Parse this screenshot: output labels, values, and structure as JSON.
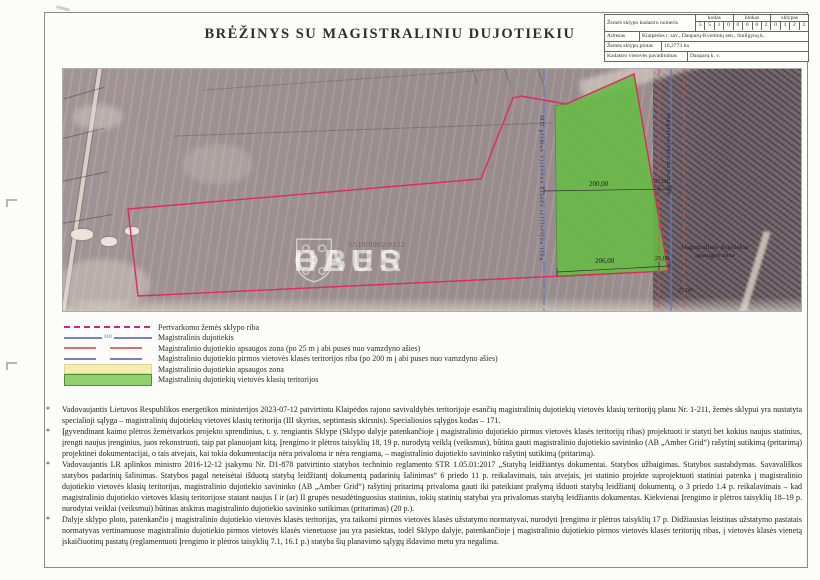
{
  "title": "BRĖŽINYS SU MAGISTRALINIU DUJOTIEKIU",
  "info_table": {
    "cadastre_label": "Žemės sklypo kadastro numeris",
    "col_headers": [
      "kodas",
      "blokas",
      "sklypas"
    ],
    "code_digits": [
      "5",
      "5",
      "1",
      "0"
    ],
    "block_digits": [
      "0",
      "0",
      "0",
      "2"
    ],
    "plot_digits": [
      "0",
      "1",
      "2",
      "2"
    ],
    "address_label": "Adresas",
    "address_value": "Klaipėdos r. sav., Dauparų-Kvietinių sen., Smilgynų k.",
    "area_label": "Žemės sklypo plotas",
    "area_value": "16,2773 ha",
    "cadastre_area_label": "Kadastro vietovės pavadinimas",
    "cadastre_area_value": "Dauparų k. v."
  },
  "map": {
    "parcel_number": "5510/0002:0122",
    "dim_200": "200,00",
    "dim_206": "206,00",
    "dim_25": "25,00",
    "md_boundary_label": "MD pirmos vietovės klasės teritorijos riba",
    "pipeline_label": "Magistralinis dujotiekis",
    "protection_label_line1": "Magistralinio dujotiekio",
    "protection_label_line2": "apsaugos zona",
    "watermark_left": "OBER",
    "watermark_right": "HAUS"
  },
  "legend": {
    "md_mark": "MD",
    "items": [
      {
        "type": "dash-magenta",
        "label": "Pertvarkomo žemės sklypo riba"
      },
      {
        "type": "line-blue-md",
        "label": "Magistralinis dujotiekis"
      },
      {
        "type": "dash-red",
        "label": "Magistralinio dujotiekio apsaugos zona (po 25 m į abi puses nuo vamzdyno ašies)"
      },
      {
        "type": "dash-blue",
        "label": "Magistralinio dujotiekio pirmos vietovės klasės teritorijos riba (po 200 m į abi puses nuo vamzdyno ašies)"
      },
      {
        "type": "fill-yellow",
        "label": "Magistralinio dujotiekio apsaugos zona"
      },
      {
        "type": "fill-green",
        "label": "Magistralinių dujotiekių vietovės klasių teritorijos"
      }
    ]
  },
  "notes_bullet": "*",
  "notes": [
    "Vadovaujantis Lietuvos Respublikos energetikos ministerijos 2023-07-12 patvirtintu Klaipėdos rajono savivaldybės teritorijoje esančių magistralinių dujotiekių vietovės klasių teritorijų planu Nr. 1-211, žemės sklypui yra nustatyta specialioji sąlyga – magistralinių dujotiekių vietovės klasių teritorija (III skyrius, septintasis skirsnis). Specialiosios sąlygos kodas – 171.",
    "Įgyvendinant kaimo plėtros žemėtvarkos projekto sprendinius, t. y. rengiantis Sklype (Sklypo dalyje patenkančioje į magistralinio dujotiekio pirmos vietovės klasės teritorijų ribas) projektuoti ir statyti bet kokius naujus statinius, įrengti naujus įrenginius, juos rekonstruoti, taip pat planuojant kitą, Įrengimo ir plėtros taisyklių 18, 19 p. nurodytą veiklą (veiksmus), būtina gauti magistralinio dujotiekio savininko (AB „Amber Grid“) rašytinį sutikimą (pritarimą) projektinei dokumentacijai, o tais atvejais, kai tokia dokumentacija nėra privaloma ir nėra rengiama, – magistralinio dujotiekio savininko rašytinį sutikimą (pritarimą).",
    "Vadovaujantis LR aplinkos ministro 2016-12-12 įsakymu Nr. D1-878 patvirtinto statybos techninio reglamento STR 1.05.01:2017 „Statybą leidžiantys dokumentai. Statybos užbaigimas. Statybos sustabdymas. Savavališkos statybos padarinių šalinimas. Statybos pagal neteisėtai išduotą statybą leidžiantį dokumentą padarinių šalinimas“ 6 priedo 11 p. reikalavimais, tais atvejais, jei statinio projekte suprojektuoti statiniai patenka į magistralinio dujotiekio vietovės klasių teritorijas, magistralinio dujotiekio savininko (AB „Amber Grid“) rašytinį pritarimą privaloma gauti iki pateikiant prašymą išduoti statybą leidžiantį dokumentą, o 3 priedo 1.4 p. reikalavimais – kad magistralinio dujotiekio vietovės klasių teritorijose statant naujus I ir (ar) II grupės nesudėtinguosius statinius, tokių statinių statybai yra privalomas statybą leidžiantis dokumentas. Kiekvienai Įrengimo ir plėtros taisyklių 18–19 p. nurodytai veiklai (veiksmui) būtinas atskiras magistralinio dujotiekio savininko sutikimas (pritarimas) (20 p.).",
    "Dalyje sklypo ploto, patenkančio į magistralinio dujotiekio vietovės klasės teritorijas, yra taikomi pirmos vietovės klasės užstatymo normatyvai, nurodyti Įrengimo ir plėtros taisyklių 17 p. Didžiausias leistinas užstatymo pastatais normatyvas vertinamuose magistralinio dujotiekio pirmos vietovės klasės vienetuose jau yra pasiektas, todėl Sklypo dalyje, patenkančioje į magistralinio dujotiekio pirmos vietovės klasės teritorijų ribas, į vietovės klasės vienetą įskaičiuotinų pastatų (reglamentuoti Įrengimo ir plėtros taisyklių 7.1, 16.1 p.) statyba šių planavimo sąlygų išdavimo metu yra negalima."
  ],
  "colors": {
    "plot_boundary": "#e02a60",
    "pipeline_blue": "#6a77bb",
    "protection_red": "#d05050",
    "zone_yellow": "#f4edb0",
    "territory_green": "#66bb44"
  }
}
